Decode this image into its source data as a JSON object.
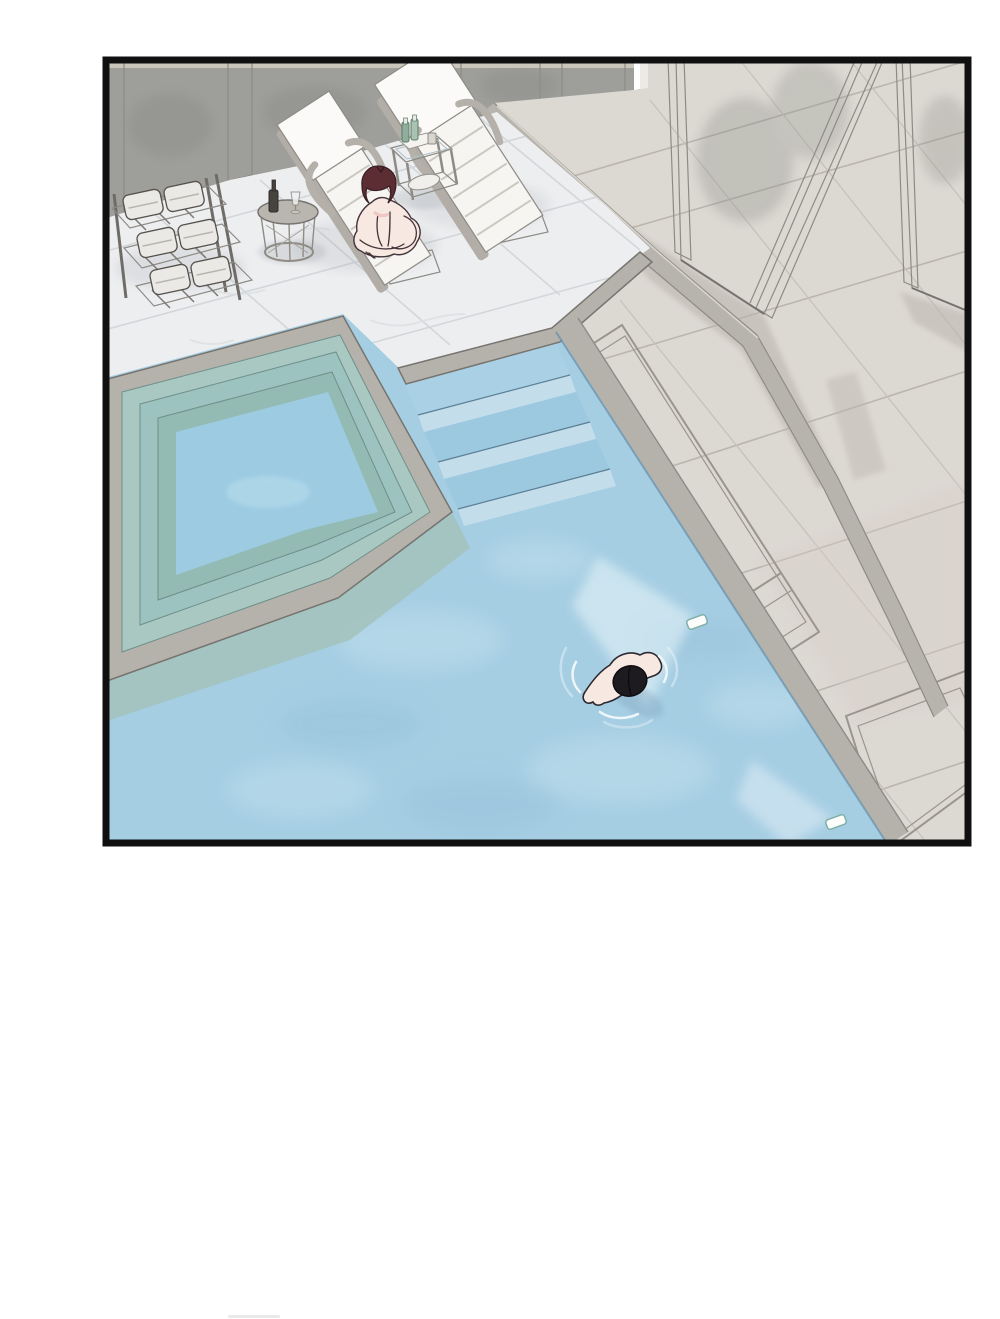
{
  "panel": {
    "kind": "borderless webtoon comic panel with black frame",
    "setting": "overhead isometric view of an indoor swimming pool room",
    "objects": [
      "three-tier slatted shelf stacked with folded white towels",
      "round wire side table holding a dark bottle and a glass",
      "two white slatted sun loungers on a marble deck",
      "small glass side table with a tray, two green bottles and a cup",
      "woman with dark auburn bob hair sitting cross-legged on a lounger",
      "raised square spa tub with tiered submerged steps",
      "wide entry steps descending into the main pool",
      "swimmer with black hair floating face-down, arms spread, ripples around",
      "two underwater pool lights casting pale beams",
      "two tall gray partition wall panels on a beige tiled walkway",
      "gray wall with vertical posts along the back",
      "white marble tiled pool deck"
    ]
  },
  "palette": {
    "frame": "#101010",
    "wall": "#9e9f9b",
    "wall_post": "#cbc6bc",
    "wall_plinth": "#d6d1c8",
    "doorway": "#eceae4",
    "corridor": "#dcd8d2",
    "curb": "#b7b3ad",
    "shadow": "#b9b3ab",
    "warm_tint": "#d8cdc9",
    "partition": "#a4a5a1",
    "partition_frame": "#cec8bc",
    "marble": "#edeef0",
    "coping": "#b5b2ac",
    "water": "#a6cee3",
    "water_light": "#c2dfee",
    "water_dark": "#8fbcd6",
    "spa_teal": "#aac8c2",
    "spa_teal_2": "#9cc3c0",
    "spa_teal_dark": "#93bab3",
    "spa_water": "#9ccbe2",
    "spa_shelf": "#a3c2bc",
    "step_top": "#a9d0e5",
    "step_top_2": "#9cc8e0",
    "step_face": "#c4ddeb",
    "beam": "#eaf5fa",
    "towel": "#ebe9e5",
    "rack": "#a8a5a0",
    "lounger": "#f6f5f2",
    "lounger_back": "#fbfaf8",
    "lounger_frame": "#b2aea7",
    "foot_box": "#eceae6",
    "glass": "#cfe0e6",
    "shelf": "#d8d5d0",
    "tray": "#f4f3f0",
    "bottle_green": "#8fae9c",
    "bottle_green_2": "#a9c2b2",
    "bottle_dark": "#47443f",
    "table_top": "#b9b6b0",
    "skin": "#f7e9e1",
    "hair_woman": "#5c2e34",
    "bikini": "#eec7c3",
    "hair_swimmer": "#1d1b20",
    "swim_shadow": "#7fa2bc",
    "fixture": "#fdfdfb",
    "page_smudge": "#e9e9e9"
  }
}
